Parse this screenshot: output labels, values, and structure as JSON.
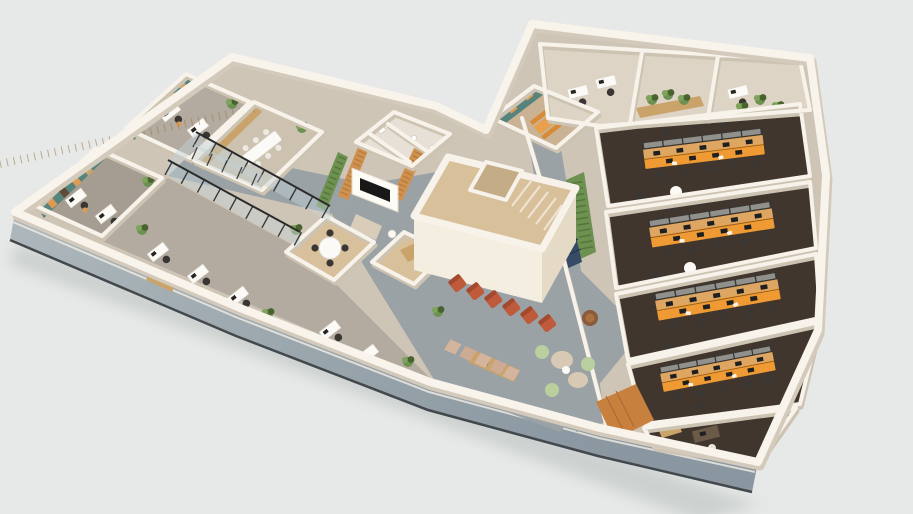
{
  "scene": {
    "kind": "3d-office-floor-plan-render",
    "description": "Isometric cutaway 3D rendering of an office floor plan on a plain light-grey backdrop. An angular white building with a glazed lower facade: west wing with teal feature-wall offices, a timber meeting room and a glazed corridor; central block with reception (timber slats, plant wall, media wall), restrooms, a tall stair core, kitchenette and a lounge with terracotta armchairs and green poufs; east wing with stacked team offices fitted with shared orange bench desks on dark carpet.",
    "background": "#e7e9e8",
    "colors": {
      "base_floor": "#cfc5b6",
      "wall_white": "#f7f2ea",
      "wall_face_bright": "#f4eee1",
      "wall_face_shade": "#e5dac6",
      "facade_dark_line": "#43484d",
      "facade_glass_light": "#aeb8bc",
      "facade_glass_dark": "#8a96a0",
      "corridor_gray": "#9aa2a6",
      "office_floor_taupe": "#b3aaa0",
      "office_floor_dark_taupe": "#a59d92",
      "meeting_floor": "#cdc2b0",
      "small_meeting_floor": "#d8c09c",
      "stair_floor": "#d8c09a",
      "stair_void": "#c3ac86",
      "toilet_floor": "#e6e0d6",
      "utility_floor": "#d8c09a",
      "kitchen_floor": "#c9b394",
      "strip_floor": "#ded4c5",
      "dark_carpet": "#40362e",
      "teal_wall": "#56837c",
      "art_orange": "#dd9a55",
      "art_brown": "#5f4a36",
      "art_tan": "#c9a36a",
      "desk_orange": "#ef9a33",
      "desk_wood": "#d9a96c",
      "terracotta": "#bf5b3a",
      "terracotta_dark": "#a34a2e",
      "pouf_green": "#b9cf9e",
      "pouf_beige": "#d7c9b3",
      "plant_green": "#6d9150",
      "plant_dark": "#49632f",
      "wood_slat": "#d0914f",
      "timber_cabinet": "#c9a36a",
      "mullion_black": "#2b2b2b",
      "glass_tint": "#c3d2d8",
      "locker_navy": "#374a66",
      "tv_black": "#181818",
      "furniture_white": "#fbfaf6",
      "chair_dark": "#3a3633",
      "terrace_tile": "#d5b49e",
      "wood_floor": "#c8803f",
      "sofa_beige": "#d9cdb9",
      "armchair_brown": "#8a5a3a"
    },
    "rooms": [
      {
        "id": "private-office-a",
        "label": "Private office, teal feature wall with artwork",
        "wing": "west"
      },
      {
        "id": "private-office-b",
        "label": "Private office, teal feature wall with artwork",
        "wing": "west"
      },
      {
        "id": "meeting-room",
        "label": "Meeting room with timber storage wall",
        "wing": "west"
      },
      {
        "id": "open-workspace",
        "label": "Open workspace along glazed facade",
        "wing": "west"
      },
      {
        "id": "small-meeting-room",
        "label": "Small meeting room with round table",
        "wing": "west"
      },
      {
        "id": "glazed-corridor",
        "label": "Glazed corridor with black mullions",
        "wing": "west"
      },
      {
        "id": "reception",
        "label": "Reception with timber slat walls, plant wall and media wall",
        "wing": "center"
      },
      {
        "id": "restrooms",
        "label": "Restrooms",
        "wing": "center"
      },
      {
        "id": "stair-core",
        "label": "Tall stair core",
        "wing": "center"
      },
      {
        "id": "utility-room",
        "label": "Lift / utility room",
        "wing": "center"
      },
      {
        "id": "lounge",
        "label": "Lounge with terracotta armchairs, poufs and bookshelf",
        "wing": "center"
      },
      {
        "id": "kitchenette",
        "label": "Kitchenette with teal cabinets and orange dining set",
        "wing": "center"
      },
      {
        "id": "locker-corridor",
        "label": "Corridor with navy lockers and plant wall",
        "wing": "east"
      },
      {
        "id": "quiet-rooms",
        "label": "Quiet rooms and planter strip",
        "wing": "east"
      },
      {
        "id": "team-office-1",
        "label": "Team office, shared orange bench desks",
        "wing": "east"
      },
      {
        "id": "team-office-2",
        "label": "Team office, shared orange bench desks",
        "wing": "east"
      },
      {
        "id": "team-office-3",
        "label": "Team office, shared orange bench desks",
        "wing": "east"
      },
      {
        "id": "team-office-4",
        "label": "Team office, shared orange bench desks",
        "wing": "east"
      },
      {
        "id": "executive-office",
        "label": "Executive office",
        "wing": "east"
      }
    ],
    "details": {
      "orange_bench_rows": 4,
      "terracotta_armchairs": 6,
      "teal_feature_walls": 2,
      "plant_walls": 2,
      "camera": "aerial three-quarter view, building rotated diagonally"
    }
  }
}
